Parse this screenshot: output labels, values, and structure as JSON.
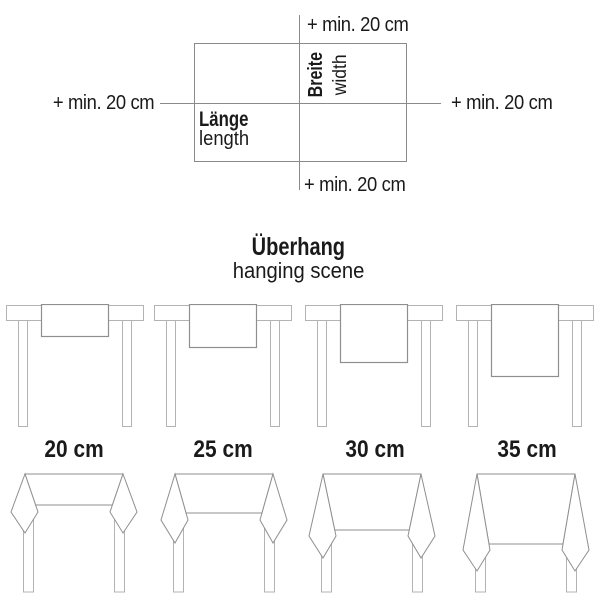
{
  "colors": {
    "text": "#1a1a1a",
    "guide_line": "#8a8a8a",
    "table_outline": "#b3b3b3",
    "cloth_outline": "#8f8f8f"
  },
  "size_diagram": {
    "label_top": "+ min. 20 cm",
    "label_left": "+ min. 20 cm",
    "label_right": "+ min. 20 cm",
    "label_bottom": "+ min. 20 cm",
    "width_de": "Breite",
    "width_en": "width",
    "length_de": "Länge",
    "length_en": "length"
  },
  "overhang": {
    "title_de": "Überhang",
    "title_en": "hanging scene",
    "variants": [
      {
        "label": "20 cm",
        "runner_drop": 32,
        "hem_drop": 31,
        "side_drop": 38,
        "point_drop": 59
      },
      {
        "label": "25 cm",
        "runner_drop": 43,
        "hem_drop": 39,
        "side_drop": 46,
        "point_drop": 69
      },
      {
        "label": "30 cm",
        "runner_drop": 58,
        "hem_drop": 56,
        "side_drop": 62,
        "point_drop": 84
      },
      {
        "label": "35 cm",
        "runner_drop": 72,
        "hem_drop": 70,
        "side_drop": 76,
        "point_drop": 97
      }
    ]
  }
}
